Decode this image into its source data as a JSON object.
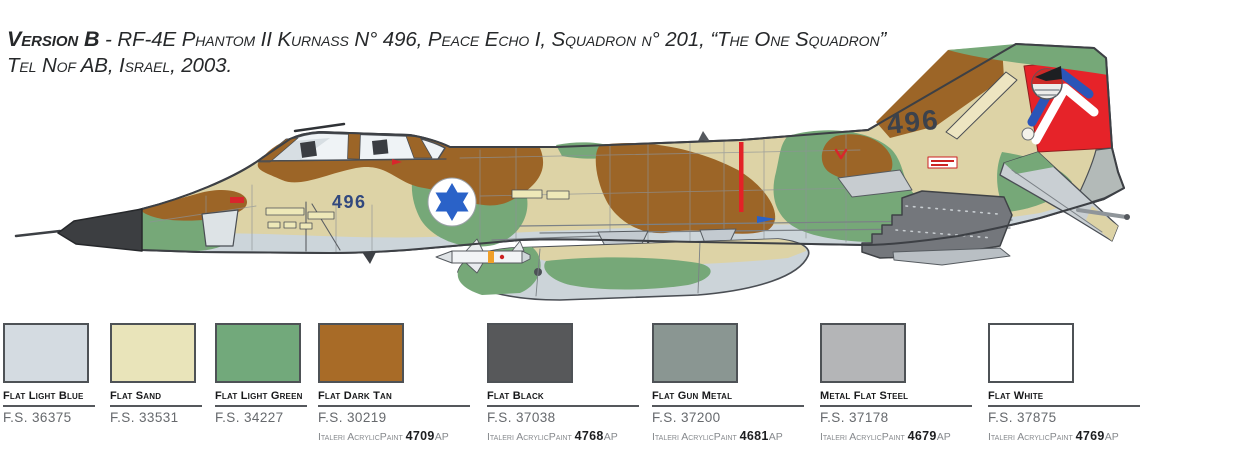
{
  "title": {
    "version_label": "Version B",
    "line1_rest": " - RF-4E Phantom II Kurnass N° 496, Peace Echo I, Squadron n° 201, “The One Squadron”",
    "line2": "Tel Nof AB, Israel, 2003."
  },
  "aircraft": {
    "nose_number": "496",
    "tail_number": "496",
    "camouflage_colors": {
      "sand": "#ddd3a6",
      "dark_tan": "#9c6527",
      "light_green": "#76a878",
      "belly_gray": "#ccd5da",
      "radome_black": "#3c3e41",
      "rudder_red": "#e62329",
      "roundel_blue": "#2a62c8",
      "chevron_blue": "#2b55b8"
    }
  },
  "palette": {
    "swatches": [
      {
        "name": "Flat Light Blue",
        "fs": "F.S. 36375",
        "color": "#d4dbe1"
      },
      {
        "name": "Flat Sand",
        "fs": "F.S. 33531",
        "color": "#e9e4ba"
      },
      {
        "name": "Flat Light Green",
        "fs": "F.S. 34227",
        "color": "#72a97b"
      },
      {
        "name": "Flat Dark Tan",
        "fs": "F.S. 30219",
        "color": "#a86b27",
        "paint_brand": "Italeri AcrylicPaint",
        "paint_code": "4709",
        "paint_suffix": "AP"
      },
      {
        "name": "Flat Black",
        "fs": "F.S. 37038",
        "color": "#57585a",
        "paint_brand": "Italeri AcrylicPaint",
        "paint_code": "4768",
        "paint_suffix": "AP"
      },
      {
        "name": "Flat Gun Metal",
        "fs": "F.S. 37200",
        "color": "#8a9692",
        "paint_brand": "Italeri AcrylicPaint",
        "paint_code": "4681",
        "paint_suffix": "AP"
      },
      {
        "name": "Metal Flat Steel",
        "fs": "F.S. 37178",
        "color": "#b4b5b7",
        "paint_brand": "Italeri AcrylicPaint",
        "paint_code": "4679",
        "paint_suffix": "AP"
      },
      {
        "name": "Flat White",
        "fs": "F.S. 37875",
        "color": "#ffffff",
        "paint_brand": "Italeri AcrylicPaint",
        "paint_code": "4769",
        "paint_suffix": "AP"
      }
    ]
  }
}
